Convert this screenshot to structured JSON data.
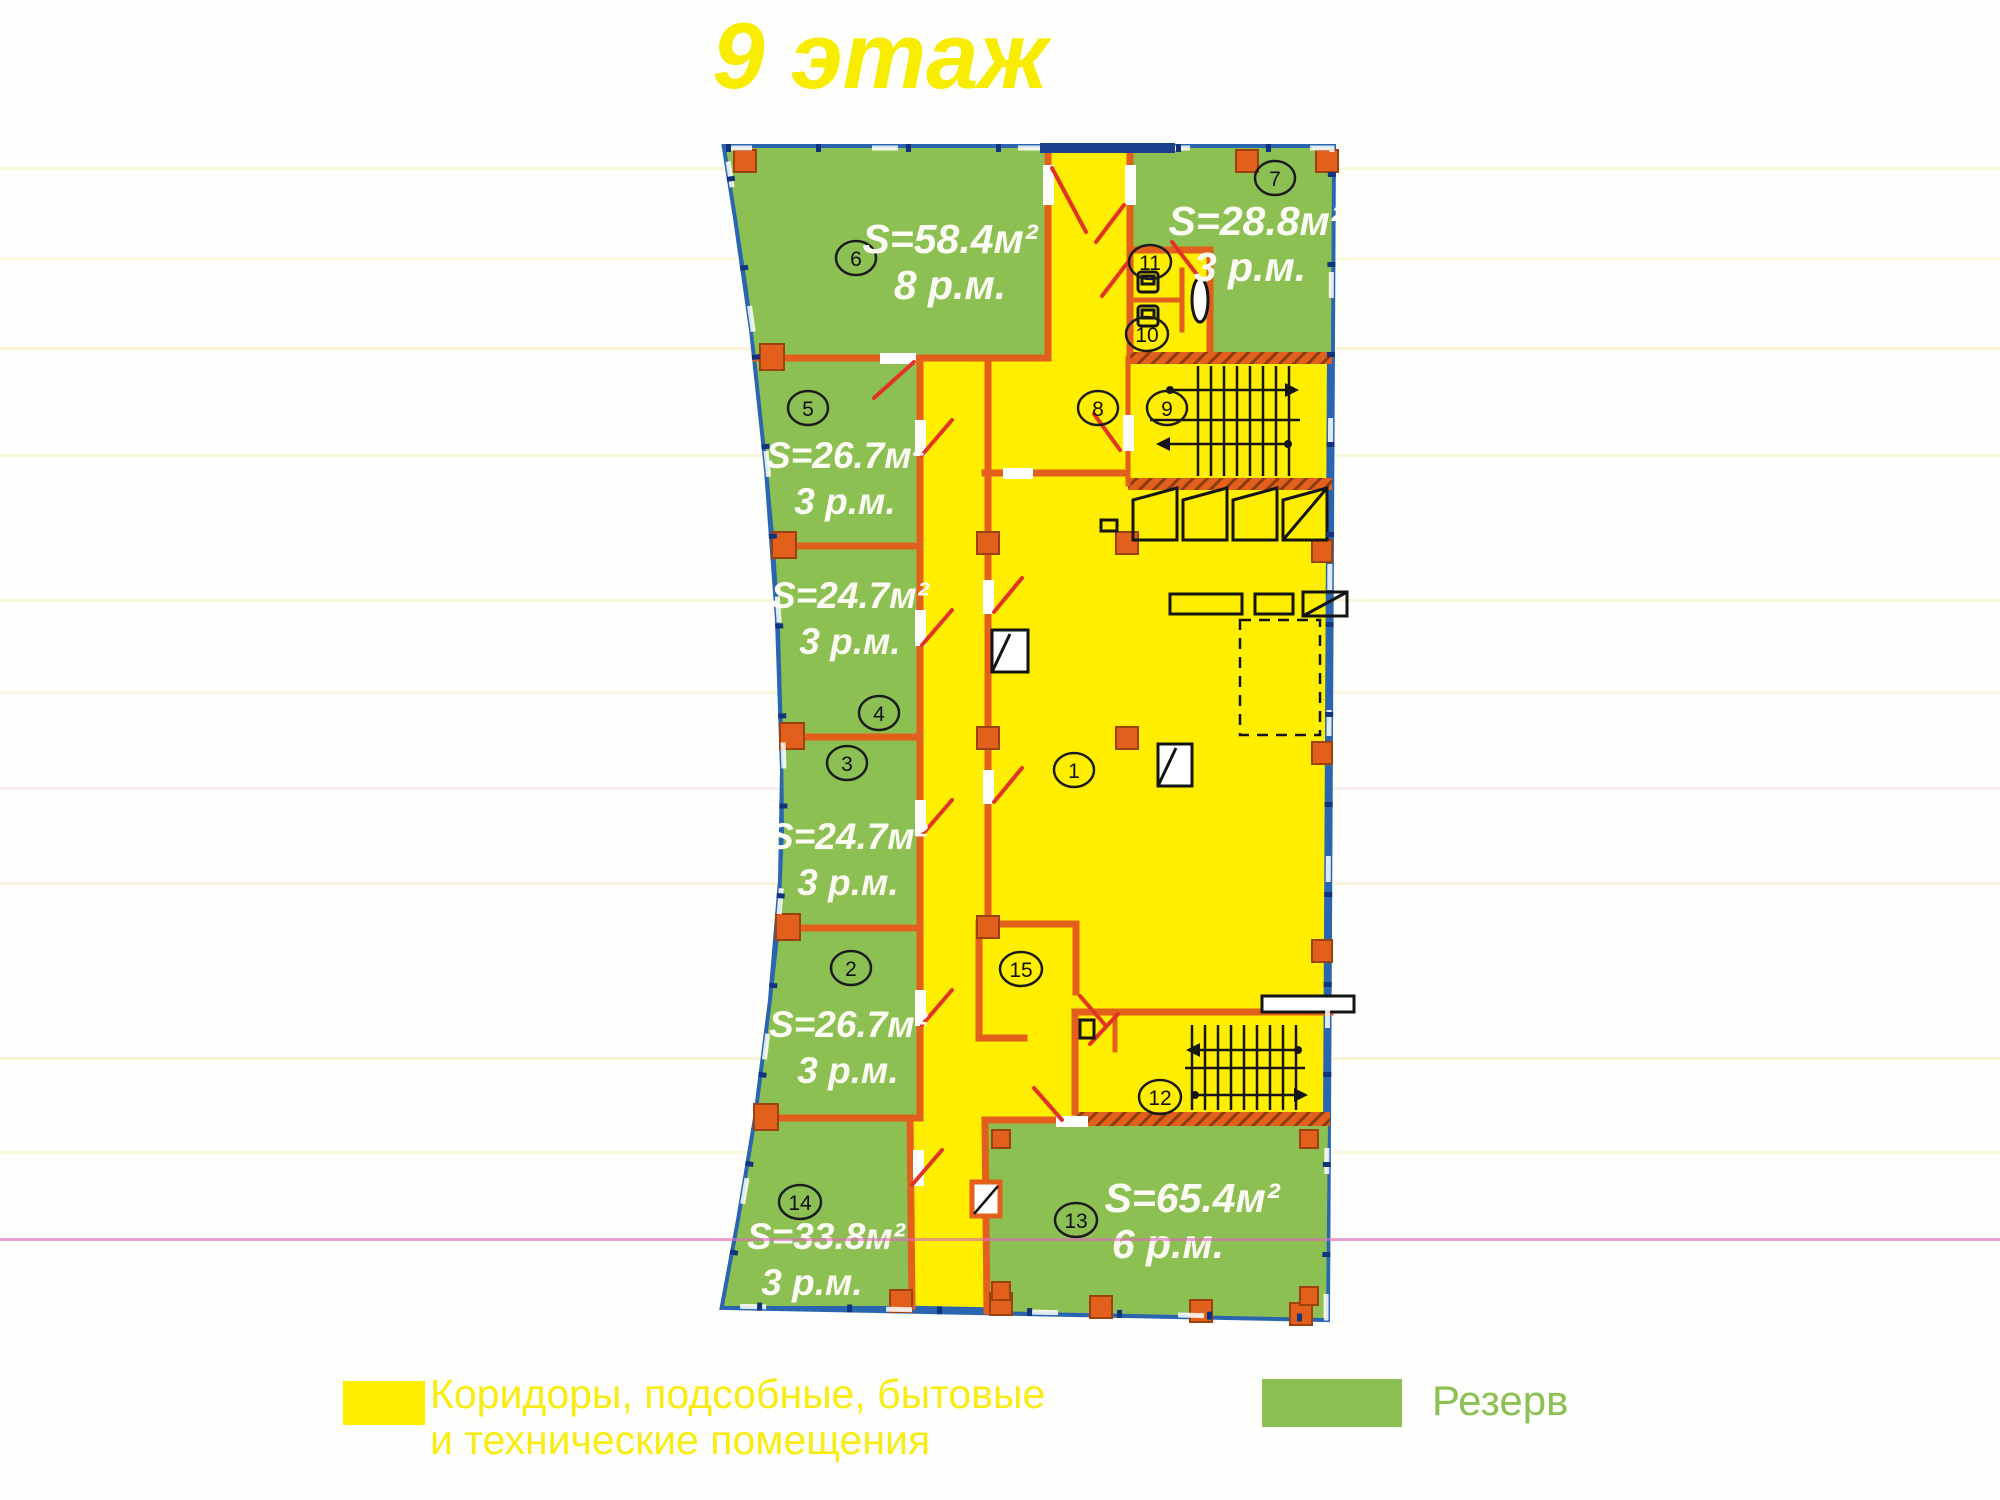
{
  "title": "9 этаж",
  "legend": {
    "corridors_line1": "Коридоры, подсобные, бытовые",
    "corridors_line2": "и технические помещения",
    "reserve": "Резерв"
  },
  "colors": {
    "corridor_yellow": "#ffee00",
    "reserve_green": "#8dc052",
    "wall_orange": "#e2601c",
    "border_blue": "#2a66b0",
    "door_swing_red": "#e23426",
    "title_yellow": "#f8ec00",
    "scanline_magenta": "#d86fb8"
  },
  "rooms": [
    {
      "number": "1"
    },
    {
      "number": "2",
      "area": "S=26.7м²",
      "places": "3 р.м."
    },
    {
      "number": "3",
      "area": "S=24.7м²",
      "places": "3 р.м."
    },
    {
      "number": "4",
      "area": "S=24.7м²",
      "places": "3 р.м."
    },
    {
      "number": "5",
      "area": "S=26.7м²",
      "places": "3 р.м."
    },
    {
      "number": "6",
      "area": "S=58.4м²",
      "places": "8 р.м."
    },
    {
      "number": "7",
      "area": "S=28.8м²",
      "places": "3 р.м."
    },
    {
      "number": "8"
    },
    {
      "number": "9"
    },
    {
      "number": "10"
    },
    {
      "number": "11"
    },
    {
      "number": "12"
    },
    {
      "number": "13",
      "area": "S=65.4м²",
      "places": "6 р.м."
    },
    {
      "number": "14",
      "area": "S=33.8м²",
      "places": "3 р.м."
    },
    {
      "number": "15"
    }
  ]
}
